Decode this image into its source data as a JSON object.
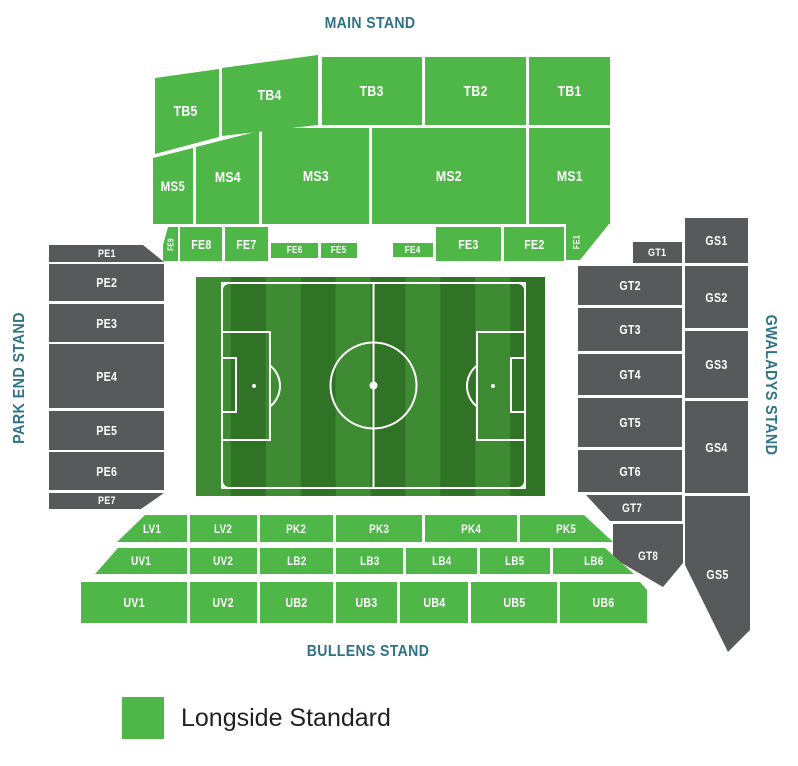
{
  "colors": {
    "longside_green": "#4EB748",
    "unavailable_gray": "#58595B",
    "stand_label_teal": "#2E7386",
    "pitch_light": "#3E8B33",
    "pitch_dark": "#317326",
    "pitch_line": "#FFFFFF"
  },
  "stadium": {
    "stands": {
      "main": {
        "label": "MAIN STAND"
      },
      "park_end": {
        "label": "PARK END STAND"
      },
      "gwaladys": {
        "label": "GWALADYS STAND"
      },
      "bullens": {
        "label": "BULLENS STAND"
      }
    },
    "sections": [
      {
        "id": "TB5",
        "label": "TB5",
        "color": "green",
        "x": 153,
        "y": 69,
        "w": 66,
        "h": 85,
        "clip": "2px 9px,66px 0,66px 68px,2px 85px",
        "fs": 15
      },
      {
        "id": "TB4",
        "label": "TB4",
        "color": "green",
        "x": 222,
        "y": 55,
        "w": 96,
        "h": 81,
        "clip": "0 13px,96px 0,96px 70px,0 81px",
        "fs": 15
      },
      {
        "id": "TB3",
        "label": "TB3",
        "color": "green",
        "x": 322,
        "y": 57,
        "w": 100,
        "h": 68,
        "fs": 15
      },
      {
        "id": "TB2",
        "label": "TB2",
        "color": "green",
        "x": 425,
        "y": 57,
        "w": 101,
        "h": 68,
        "fs": 15
      },
      {
        "id": "TB1",
        "label": "TB1",
        "color": "green",
        "x": 529,
        "y": 57,
        "w": 81,
        "h": 68,
        "fs": 15
      },
      {
        "id": "MS5",
        "label": "MS5",
        "color": "green",
        "x": 153,
        "y": 148,
        "w": 40,
        "h": 76,
        "clip": "0 10px,40px 0,40px 76px,0 76px",
        "fs": 14
      },
      {
        "id": "MS4",
        "label": "MS4",
        "color": "green",
        "x": 196,
        "y": 131,
        "w": 63,
        "h": 93,
        "clip": "0 16px,63px 0,63px 93px,0 93px",
        "fs": 15
      },
      {
        "id": "MS3",
        "label": "MS3",
        "color": "green",
        "x": 262,
        "y": 128,
        "w": 107,
        "h": 96,
        "fs": 15
      },
      {
        "id": "MS2",
        "label": "MS2",
        "color": "green",
        "x": 372,
        "y": 128,
        "w": 154,
        "h": 96,
        "fs": 15
      },
      {
        "id": "MS1",
        "label": "MS1",
        "color": "green",
        "x": 529,
        "y": 128,
        "w": 81,
        "h": 96,
        "fs": 15
      },
      {
        "id": "FE9",
        "label": "FE9",
        "color": "green",
        "x": 163,
        "y": 227,
        "w": 15,
        "h": 34,
        "clip": "5px 0,15px 0,15px 34px,0 34px,0 18px",
        "fs": 8,
        "rot": true
      },
      {
        "id": "FE8",
        "label": "FE8",
        "color": "green",
        "x": 180,
        "y": 227,
        "w": 42,
        "h": 34,
        "fs": 13
      },
      {
        "id": "FE7",
        "label": "FE7",
        "color": "green",
        "x": 225,
        "y": 227,
        "w": 43,
        "h": 34,
        "fs": 13
      },
      {
        "id": "FE6",
        "label": "FE6",
        "color": "green",
        "x": 271,
        "y": 243,
        "w": 47,
        "h": 15,
        "fs": 10
      },
      {
        "id": "FE5",
        "label": "FE5",
        "color": "green",
        "x": 321,
        "y": 243,
        "w": 36,
        "h": 15,
        "fs": 10
      },
      {
        "id": "FE4",
        "label": "FE4",
        "color": "green",
        "x": 393,
        "y": 243,
        "w": 40,
        "h": 14,
        "fs": 10
      },
      {
        "id": "FE3",
        "label": "FE3",
        "color": "green",
        "x": 436,
        "y": 227,
        "w": 65,
        "h": 34,
        "fs": 13
      },
      {
        "id": "FE2",
        "label": "FE2",
        "color": "green",
        "x": 504,
        "y": 227,
        "w": 60,
        "h": 34,
        "fs": 13
      },
      {
        "id": "FE1",
        "label": "FE1",
        "color": "green",
        "x": 566,
        "y": 224,
        "w": 43,
        "h": 36,
        "clip": "0 0,43px 0,14px 36px,0 36px",
        "fs": 9,
        "rot": true,
        "jc": "flex-start",
        "pl": 2
      },
      {
        "id": "PE1",
        "label": "PE1",
        "color": "gray",
        "x": 49,
        "y": 245,
        "w": 115,
        "h": 17,
        "clip": "0 0,94px 0,115px 17px,0 17px",
        "fs": 11
      },
      {
        "id": "PE2",
        "label": "PE2",
        "color": "gray",
        "x": 49,
        "y": 264,
        "w": 115,
        "h": 37,
        "fs": 13
      },
      {
        "id": "PE3",
        "label": "PE3",
        "color": "gray",
        "x": 49,
        "y": 304,
        "w": 115,
        "h": 38,
        "fs": 13
      },
      {
        "id": "PE4",
        "label": "PE4",
        "color": "gray",
        "x": 49,
        "y": 344,
        "w": 115,
        "h": 64,
        "fs": 13
      },
      {
        "id": "PE5",
        "label": "PE5",
        "color": "gray",
        "x": 49,
        "y": 411,
        "w": 115,
        "h": 39,
        "fs": 13
      },
      {
        "id": "PE6",
        "label": "PE6",
        "color": "gray",
        "x": 49,
        "y": 452,
        "w": 115,
        "h": 38,
        "fs": 13
      },
      {
        "id": "PE7",
        "label": "PE7",
        "color": "gray",
        "x": 49,
        "y": 493,
        "w": 115,
        "h": 16,
        "clip": "0 0,115px 0,92px 16px,0 16px",
        "fs": 11
      },
      {
        "id": "GT1",
        "label": "GT1",
        "color": "gray",
        "x": 633,
        "y": 242,
        "w": 49,
        "h": 21,
        "fs": 11
      },
      {
        "id": "GT2",
        "label": "GT2",
        "color": "gray",
        "x": 578,
        "y": 266,
        "w": 104,
        "h": 39,
        "fs": 13
      },
      {
        "id": "GT3",
        "label": "GT3",
        "color": "gray",
        "x": 578,
        "y": 308,
        "w": 104,
        "h": 43,
        "fs": 13
      },
      {
        "id": "GT4",
        "label": "GT4",
        "color": "gray",
        "x": 578,
        "y": 354,
        "w": 104,
        "h": 41,
        "fs": 13
      },
      {
        "id": "GT5",
        "label": "GT5",
        "color": "gray",
        "x": 578,
        "y": 398,
        "w": 104,
        "h": 49,
        "fs": 13
      },
      {
        "id": "GT6",
        "label": "GT6",
        "color": "gray",
        "x": 578,
        "y": 450,
        "w": 104,
        "h": 42,
        "fs": 13
      },
      {
        "id": "GT7",
        "label": "GT7",
        "color": "gray",
        "x": 583,
        "y": 495,
        "w": 99,
        "h": 26,
        "clip": "3px 0,99px 0,99px 26px,27px 26px",
        "fs": 12
      },
      {
        "id": "GT8",
        "label": "GT8",
        "color": "gray",
        "x": 613,
        "y": 524,
        "w": 70,
        "h": 63,
        "clip": "0 0,70px 0,70px 39px,50px 63px,0 34px",
        "fs": 12
      },
      {
        "id": "GS1",
        "label": "GS1",
        "color": "gray",
        "x": 685,
        "y": 218,
        "w": 63,
        "h": 45,
        "fs": 13
      },
      {
        "id": "GS2",
        "label": "GS2",
        "color": "gray",
        "x": 685,
        "y": 266,
        "w": 63,
        "h": 62,
        "fs": 13
      },
      {
        "id": "GS3",
        "label": "GS3",
        "color": "gray",
        "x": 685,
        "y": 331,
        "w": 63,
        "h": 67,
        "fs": 13
      },
      {
        "id": "GS4",
        "label": "GS4",
        "color": "gray",
        "x": 685,
        "y": 401,
        "w": 63,
        "h": 92,
        "fs": 13
      },
      {
        "id": "GS5",
        "label": "GS5",
        "color": "gray",
        "x": 685,
        "y": 496,
        "w": 65,
        "h": 156,
        "clip": "0 0,65px 0,65px 134px,43px 156px,0 69px",
        "fs": 13
      },
      {
        "id": "LV1",
        "label": "LV1",
        "color": "green",
        "x": 117,
        "y": 515,
        "w": 70,
        "h": 27,
        "clip": "28px 0,70px 0,70px 27px,0 27px",
        "fs": 12
      },
      {
        "id": "LV2",
        "label": "LV2",
        "color": "green",
        "x": 190,
        "y": 515,
        "w": 67,
        "h": 27,
        "fs": 12
      },
      {
        "id": "PK2",
        "label": "PK2",
        "color": "green",
        "x": 260,
        "y": 515,
        "w": 73,
        "h": 27,
        "fs": 12
      },
      {
        "id": "PK3",
        "label": "PK3",
        "color": "green",
        "x": 336,
        "y": 515,
        "w": 86,
        "h": 27,
        "fs": 12
      },
      {
        "id": "PK4",
        "label": "PK4",
        "color": "green",
        "x": 425,
        "y": 515,
        "w": 92,
        "h": 27,
        "fs": 12
      },
      {
        "id": "PK5",
        "label": "PK5",
        "color": "green",
        "x": 520,
        "y": 515,
        "w": 93,
        "h": 27,
        "clip": "0 0,64px 0,93px 27px,0 27px",
        "fs": 12
      },
      {
        "id": "UV1-upper",
        "label": "UV1",
        "color": "green",
        "x": 95,
        "y": 548,
        "w": 92,
        "h": 26,
        "clip": "23px 0,92px 0,92px 26px,0 26px",
        "fs": 12
      },
      {
        "id": "UV2-upper",
        "label": "UV2",
        "color": "green",
        "x": 190,
        "y": 548,
        "w": 67,
        "h": 26,
        "fs": 12
      },
      {
        "id": "LB2",
        "label": "LB2",
        "color": "green",
        "x": 260,
        "y": 548,
        "w": 73,
        "h": 26,
        "fs": 12
      },
      {
        "id": "LB3",
        "label": "LB3",
        "color": "green",
        "x": 336,
        "y": 548,
        "w": 67,
        "h": 26,
        "fs": 12
      },
      {
        "id": "LB4",
        "label": "LB4",
        "color": "green",
        "x": 406,
        "y": 548,
        "w": 71,
        "h": 26,
        "fs": 12
      },
      {
        "id": "LB5",
        "label": "LB5",
        "color": "green",
        "x": 480,
        "y": 548,
        "w": 70,
        "h": 26,
        "fs": 12
      },
      {
        "id": "LB6",
        "label": "LB6",
        "color": "green",
        "x": 553,
        "y": 548,
        "w": 81,
        "h": 26,
        "clip": "0 0,52px 0,81px 26px,0 26px",
        "fs": 12
      },
      {
        "id": "UV1-lower",
        "label": "UV1",
        "color": "green",
        "x": 81,
        "y": 582,
        "w": 106,
        "h": 41,
        "fs": 13
      },
      {
        "id": "UV2-lower",
        "label": "UV2",
        "color": "green",
        "x": 190,
        "y": 582,
        "w": 67,
        "h": 41,
        "fs": 13
      },
      {
        "id": "UB2",
        "label": "UB2",
        "color": "green",
        "x": 260,
        "y": 582,
        "w": 73,
        "h": 41,
        "fs": 13
      },
      {
        "id": "UB3",
        "label": "UB3",
        "color": "green",
        "x": 336,
        "y": 582,
        "w": 61,
        "h": 41,
        "fs": 13
      },
      {
        "id": "UB4",
        "label": "UB4",
        "color": "green",
        "x": 400,
        "y": 582,
        "w": 68,
        "h": 41,
        "fs": 13
      },
      {
        "id": "UB5",
        "label": "UB5",
        "color": "green",
        "x": 471,
        "y": 582,
        "w": 86,
        "h": 41,
        "fs": 13
      },
      {
        "id": "UB6",
        "label": "UB6",
        "color": "green",
        "x": 560,
        "y": 582,
        "w": 87,
        "h": 41,
        "clip": "0 0,80px 0,87px 8px,87px 41px,0 41px",
        "fs": 13
      }
    ]
  },
  "legend": {
    "items": [
      {
        "label": "Longside Standard",
        "color": "#4EB748"
      }
    ]
  }
}
